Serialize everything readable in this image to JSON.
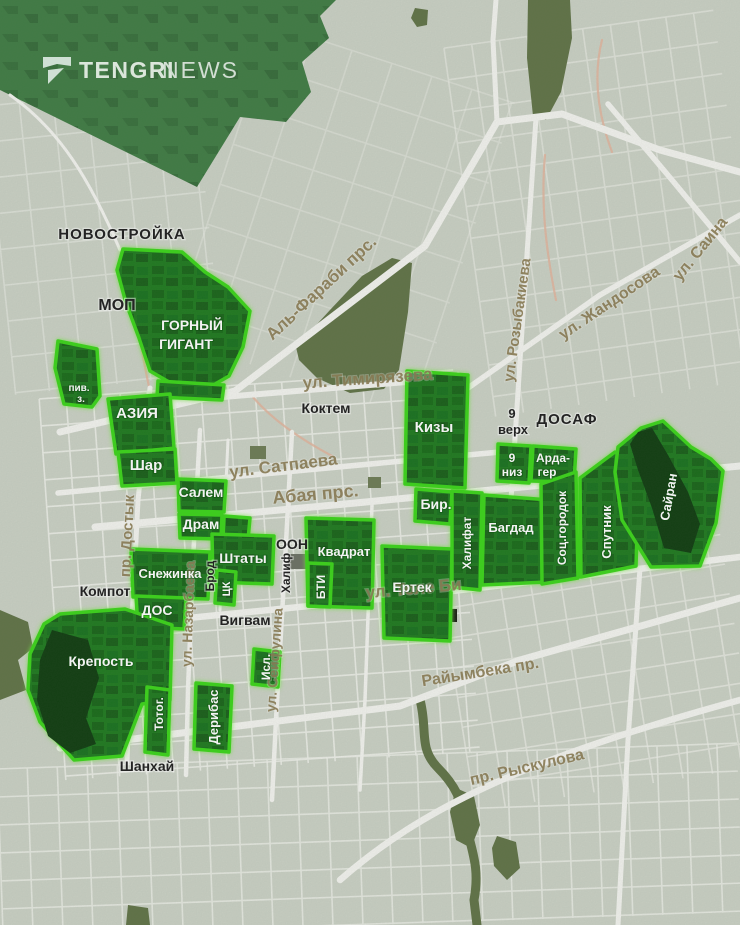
{
  "header": {
    "brand": {
      "primary": "TENGRI",
      "secondary": "NEWS"
    }
  },
  "map": {
    "districts": {
      "gorny_gigant": {
        "line1": "ГОРНЫЙ",
        "line2": "ГИГАНТ"
      },
      "piv_z": {
        "line1": "пив.",
        "line2": "з."
      },
      "aziya": {
        "label": "АЗИЯ"
      },
      "shar": {
        "label": "Шар"
      },
      "salem": {
        "label": "Салем"
      },
      "dram": {
        "label": "Драм"
      },
      "shtaty": {
        "label": "Штаты"
      },
      "snezhinka": {
        "label": "Снежинка"
      },
      "dos": {
        "label": "ДОС"
      },
      "krepost": {
        "label": "Крепость"
      },
      "totog": {
        "label": "Тотог."
      },
      "deribas": {
        "label": "Дерибас"
      },
      "isl": {
        "label": "Исл."
      },
      "tsk": {
        "label": "ЦК"
      },
      "kvadrat": {
        "label": "Квадрат"
      },
      "bti": {
        "label": "БТИ"
      },
      "ertek": {
        "label": "Ертек"
      },
      "kizy": {
        "label": "Кизы"
      },
      "bir": {
        "label": "Бир."
      },
      "khalifat": {
        "label": "Халифат"
      },
      "bagdad": {
        "label": "Багдад"
      },
      "devyat_niz": {
        "line1": "9",
        "line2": "низ"
      },
      "arda_ger": {
        "line1": "Арда-",
        "line2": "гер"
      },
      "sots_gorodok": {
        "label": "Соц.городок"
      },
      "sputnik": {
        "label": "Спутник"
      },
      "sairan": {
        "label": "Сайран"
      }
    },
    "area_labels": {
      "novostroika": "НОВОСТРОЙКА",
      "mop": "МОП",
      "koktem": "Коктем",
      "devyat_verkh": {
        "line1": "9",
        "line2": "верх"
      },
      "dosaf": "ДОСАФ",
      "oon": "ООН",
      "khalif": "Халиф",
      "brod": "Брод",
      "kompot": "Компот",
      "vigvam": "Вигвам",
      "shankhai": "Шанхай"
    },
    "streets": {
      "al_farabi": "Аль-Фараби прс.",
      "timiryazeva": "ул. Тимирязева",
      "satpaeva": "ул. Сатпаева",
      "abaya": "Абая прс.",
      "rozybakieva": "ул. Розыбакиева",
      "zhandosova": "ул. Жандосова",
      "saina": "ул. Саина",
      "dostyk": "пр. Достык",
      "nazarbaeva": "ул. Назарбаева",
      "seifulina": "ул. Сейфулина",
      "tole_bi": "ул. Толе Би",
      "raiymbeka": "Райымбека пр.",
      "ryskulova": "пр. Рыскулова"
    },
    "colors": {
      "background": "#c9d0c3",
      "street": "#f2f3ee",
      "street_label": "#8b7d54",
      "district_fill": "#1d781d",
      "district_border": "#38d414",
      "mountain": "#3d7a41",
      "park": "#5e7144",
      "water": "#0b3a10",
      "minor_road": "#e0b49c",
      "area_label": "#1b1b1b",
      "district_label": "#ffffff"
    }
  }
}
